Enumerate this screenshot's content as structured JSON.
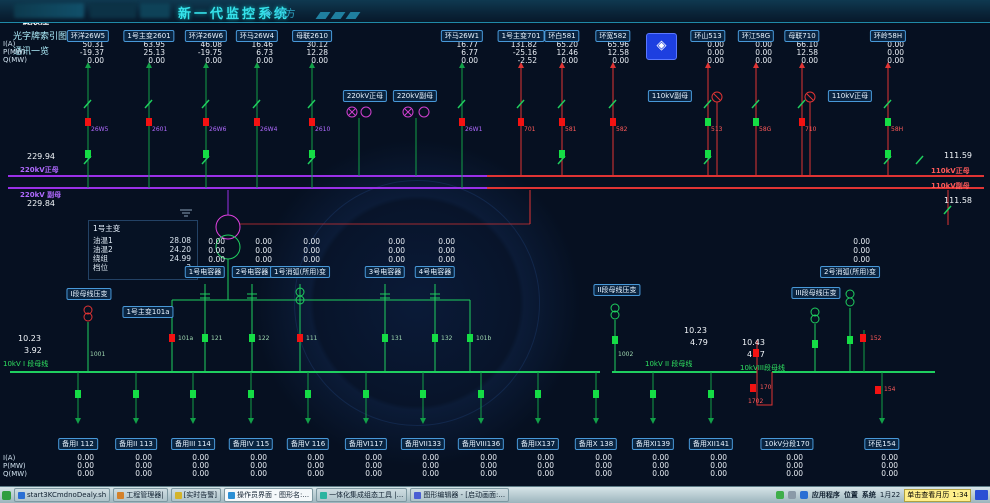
{
  "title_bar": {
    "title": "新一代监控系统",
    "vendor": "四方",
    "buttons": [
      {
        "label": "画面索引图"
      },
      {
        "label": "一键顺控",
        "state": "active"
      },
      {
        "label": "光字牌索引图"
      },
      {
        "label": "通讯一览"
      }
    ]
  },
  "icons": {
    "vendor_mark": "◈",
    "compass": "◈"
  },
  "colors": {
    "accent_cyan": "#36e2ea",
    "bus_220kv": "#9a30e8",
    "bus_110kv": "#e03434",
    "bus_10kv": "#1fcf5f",
    "breaker_closed": "#f31212",
    "breaker_open": "#15dd45",
    "background": "#061021",
    "label_border": "#4898d8",
    "tooltip_yellow": "#ffef8a"
  },
  "measure": {
    "i": "I(A)",
    "p": "P(MW)",
    "q": "Q(MW)"
  },
  "top_feeders": [
    {
      "label": "环洋26W5",
      "x": 88,
      "i": "50.31",
      "p": "-19.37",
      "q": "0.00"
    },
    {
      "label": "1号主变2601",
      "x": 149,
      "i": "63.95",
      "p": "25.13",
      "q": "0.00"
    },
    {
      "label": "环洋26W6",
      "x": 206,
      "i": "46.08",
      "p": "-19.75",
      "q": "0.00"
    },
    {
      "label": "环马26W4",
      "x": 257,
      "i": "16.46",
      "p": "6.73",
      "q": "0.00"
    },
    {
      "label": "母联2610",
      "x": 312,
      "i": "30.12",
      "p": "12.28",
      "q": "0.00"
    },
    {
      "label": "环马26W1",
      "x": 462,
      "i": "16.77",
      "p": "6.77",
      "q": "0.00"
    },
    {
      "label": "1号主变701",
      "x": 521,
      "i": "131.82",
      "p": "-25.16",
      "q": "-2.52"
    },
    {
      "label": "环白581",
      "x": 562,
      "i": "65.20",
      "p": "12.46",
      "q": "0.00"
    },
    {
      "label": "环宽582",
      "x": 613,
      "i": "65.96",
      "p": "12.58",
      "q": "0.00"
    },
    {
      "label": "环山513",
      "x": 708,
      "i": "0.00",
      "p": "0.00",
      "q": "0.00"
    },
    {
      "label": "环江58G",
      "x": 756,
      "i": "0.00",
      "p": "0.00",
      "q": "0.00"
    },
    {
      "label": "母联710",
      "x": 802,
      "i": "66.10",
      "p": "12.58",
      "q": "0.00"
    },
    {
      "label": "环岭58H",
      "x": 888,
      "i": "0.00",
      "p": "0.00",
      "q": "0.00"
    }
  ],
  "bus_boxes": [
    {
      "t": "220kV正母",
      "x": 365
    },
    {
      "t": "220kV副母",
      "x": 415
    },
    {
      "t": "110kV副母",
      "x": 670
    },
    {
      "t": "110kV正母",
      "x": 850
    }
  ],
  "bus_texts": [
    {
      "t": "220kV正母",
      "x": 20,
      "y": 165,
      "c": "vp"
    },
    {
      "t": "220kV 副母",
      "x": 20,
      "y": 190,
      "c": "vp"
    },
    {
      "t": "110kV正母",
      "x": 931,
      "y": 166,
      "c": "vr"
    },
    {
      "t": "110kV副母",
      "x": 931,
      "y": 181,
      "c": "vr"
    }
  ],
  "float_values": [
    {
      "t": "229.94",
      "x": 27,
      "y": 152
    },
    {
      "t": "229.84",
      "x": 27,
      "y": 199
    },
    {
      "t": "111.59",
      "x": 944,
      "y": 151
    },
    {
      "t": "111.58",
      "x": 944,
      "y": 196
    },
    {
      "t": "10.23",
      "x": 18,
      "y": 334
    },
    {
      "t": "3.92",
      "x": 24,
      "y": 346
    },
    {
      "t": "10.23",
      "x": 684,
      "y": 326
    },
    {
      "t": "4.79",
      "x": 690,
      "y": 338
    },
    {
      "t": "10.43",
      "x": 742,
      "y": 338
    },
    {
      "t": "4.57",
      "x": 747,
      "y": 350
    }
  ],
  "transformer": {
    "name": "1号主变",
    "rows": [
      {
        "k": "油温1",
        "v": "28.08"
      },
      {
        "k": "油温2",
        "v": "24.20"
      },
      {
        "k": "绕组",
        "v": "24.99"
      },
      {
        "k": "档位",
        "v": "3"
      }
    ]
  },
  "cap_groups": [
    {
      "label": "1号电容器",
      "x": 205,
      "v1": "0.00",
      "v2": "0.00",
      "v3": "0.00"
    },
    {
      "label": "2号电容器",
      "x": 252,
      "v1": "0.00",
      "v2": "0.00",
      "v3": "0.00"
    },
    {
      "label": "1号消弧(所用)变",
      "x": 300,
      "v1": "0.00",
      "v2": "0.00",
      "v3": "0.00"
    },
    {
      "label": "3号电容器",
      "x": 385,
      "v1": "0.00",
      "v2": "0.00",
      "v3": "0.00"
    },
    {
      "label": "4号电容器",
      "x": 435,
      "v1": "0.00",
      "v2": "0.00",
      "v3": "0.00"
    },
    {
      "label": "2号消弧(所用)变",
      "x": 850,
      "v1": "0.00",
      "v2": "0.00",
      "v3": "0.00"
    }
  ],
  "pt_boxes": [
    {
      "t": "I段母线压变",
      "x": 89,
      "y": 288
    },
    {
      "t": "1号主变101a",
      "x": 148,
      "y": 306
    },
    {
      "t": "II段母线压变",
      "x": 617,
      "y": 284
    },
    {
      "t": "III段母线压变",
      "x": 816,
      "y": 287
    }
  ],
  "bus10_labels": [
    {
      "t": "10kV I 段母线",
      "x": 3,
      "y": 359
    },
    {
      "t": "10kV II 段母线",
      "x": 645,
      "y": 359
    },
    {
      "t": "10kVIII段母线",
      "x": 740,
      "y": 363
    }
  ],
  "tags": [
    {
      "t": "26W5",
      "x": 91,
      "y": 127,
      "c": "vp"
    },
    {
      "t": "2601",
      "x": 152,
      "y": 127,
      "c": "vp"
    },
    {
      "t": "26W6",
      "x": 209,
      "y": 127,
      "c": "vp"
    },
    {
      "t": "26W4",
      "x": 260,
      "y": 127,
      "c": "vp"
    },
    {
      "t": "2610",
      "x": 315,
      "y": 127,
      "c": "vp"
    },
    {
      "t": "26W1",
      "x": 465,
      "y": 127,
      "c": "vp"
    },
    {
      "t": "701",
      "x": 524,
      "y": 127,
      "c": "vr"
    },
    {
      "t": "581",
      "x": 565,
      "y": 127,
      "c": "vr"
    },
    {
      "t": "582",
      "x": 616,
      "y": 127,
      "c": "vr"
    },
    {
      "t": "513",
      "x": 711,
      "y": 127,
      "c": "vr"
    },
    {
      "t": "58G",
      "x": 759,
      "y": 127,
      "c": "vr"
    },
    {
      "t": "710",
      "x": 805,
      "y": 127,
      "c": "vr"
    },
    {
      "t": "58H",
      "x": 891,
      "y": 127,
      "c": "vr"
    },
    {
      "t": "101a",
      "x": 178,
      "y": 336,
      "c": "vg"
    },
    {
      "t": "121",
      "x": 211,
      "y": 336,
      "c": "vg"
    },
    {
      "t": "122",
      "x": 258,
      "y": 336,
      "c": "vg"
    },
    {
      "t": "111",
      "x": 306,
      "y": 336,
      "c": "vg"
    },
    {
      "t": "131",
      "x": 391,
      "y": 336,
      "c": "vg"
    },
    {
      "t": "132",
      "x": 441,
      "y": 336,
      "c": "vg"
    },
    {
      "t": "101b",
      "x": 476,
      "y": 336,
      "c": "vg"
    },
    {
      "t": "152",
      "x": 870,
      "y": 336,
      "c": "vr"
    },
    {
      "t": "170",
      "x": 760,
      "y": 385,
      "c": "vr"
    },
    {
      "t": "1702",
      "x": 748,
      "y": 399,
      "c": "vr"
    },
    {
      "t": "154",
      "x": 884,
      "y": 387,
      "c": "vr"
    },
    {
      "t": "1001",
      "x": 90,
      "y": 352,
      "c": "vg"
    },
    {
      "t": "1002",
      "x": 618,
      "y": 352,
      "c": "vg"
    }
  ],
  "breakers": [
    {
      "x": 85,
      "y": 118,
      "state": "closed"
    },
    {
      "x": 146,
      "y": 118,
      "state": "closed"
    },
    {
      "x": 203,
      "y": 118,
      "state": "closed"
    },
    {
      "x": 254,
      "y": 118,
      "state": "closed"
    },
    {
      "x": 309,
      "y": 118,
      "state": "closed"
    },
    {
      "x": 459,
      "y": 118,
      "state": "closed"
    },
    {
      "x": 518,
      "y": 118,
      "state": "closed"
    },
    {
      "x": 559,
      "y": 118,
      "state": "closed"
    },
    {
      "x": 610,
      "y": 118,
      "state": "closed"
    },
    {
      "x": 799,
      "y": 118,
      "state": "closed"
    },
    {
      "x": 705,
      "y": 118,
      "state": "open"
    },
    {
      "x": 753,
      "y": 118,
      "state": "open"
    },
    {
      "x": 885,
      "y": 118,
      "state": "open"
    },
    {
      "x": 85,
      "y": 150,
      "state": "open"
    },
    {
      "x": 203,
      "y": 150,
      "state": "open"
    },
    {
      "x": 309,
      "y": 150,
      "state": "open"
    },
    {
      "x": 559,
      "y": 150,
      "state": "open"
    },
    {
      "x": 705,
      "y": 150,
      "state": "open"
    },
    {
      "x": 885,
      "y": 150,
      "state": "open"
    },
    {
      "x": 169,
      "y": 334,
      "state": "closed"
    },
    {
      "x": 202,
      "y": 334,
      "state": "open"
    },
    {
      "x": 249,
      "y": 334,
      "state": "open"
    },
    {
      "x": 297,
      "y": 334,
      "state": "closed"
    },
    {
      "x": 382,
      "y": 334,
      "state": "open"
    },
    {
      "x": 432,
      "y": 334,
      "state": "open"
    },
    {
      "x": 467,
      "y": 334,
      "state": "open"
    },
    {
      "x": 612,
      "y": 336,
      "state": "open"
    },
    {
      "x": 812,
      "y": 340,
      "state": "open"
    },
    {
      "x": 847,
      "y": 336,
      "state": "open"
    },
    {
      "x": 860,
      "y": 334,
      "state": "closed"
    },
    {
      "x": 750,
      "y": 384,
      "state": "closed"
    },
    {
      "x": 753,
      "y": 349,
      "state": "closed"
    },
    {
      "x": 875,
      "y": 386,
      "state": "closed"
    },
    {
      "x": 75,
      "y": 390,
      "state": "open"
    },
    {
      "x": 133,
      "y": 390,
      "state": "open"
    },
    {
      "x": 190,
      "y": 390,
      "state": "open"
    },
    {
      "x": 248,
      "y": 390,
      "state": "open"
    },
    {
      "x": 305,
      "y": 390,
      "state": "open"
    },
    {
      "x": 363,
      "y": 390,
      "state": "open"
    },
    {
      "x": 420,
      "y": 390,
      "state": "open"
    },
    {
      "x": 478,
      "y": 390,
      "state": "open"
    },
    {
      "x": 535,
      "y": 390,
      "state": "open"
    },
    {
      "x": 593,
      "y": 390,
      "state": "open"
    },
    {
      "x": 650,
      "y": 390,
      "state": "open"
    },
    {
      "x": 708,
      "y": 390,
      "state": "open"
    }
  ],
  "bottom_feeders": [
    {
      "label": "备用I 112",
      "x": 78,
      "i": "0.00",
      "p": "0.00",
      "q": "0.00"
    },
    {
      "label": "备用II 113",
      "x": 136,
      "i": "0.00",
      "p": "0.00",
      "q": "0.00"
    },
    {
      "label": "备用III 114",
      "x": 193,
      "i": "0.00",
      "p": "0.00",
      "q": "0.00"
    },
    {
      "label": "备用IV 115",
      "x": 251,
      "i": "0.00",
      "p": "0.00",
      "q": "0.00"
    },
    {
      "label": "备用V 116",
      "x": 308,
      "i": "0.00",
      "p": "0.00",
      "q": "0.00"
    },
    {
      "label": "备用VI117",
      "x": 366,
      "i": "0.00",
      "p": "0.00",
      "q": "0.00"
    },
    {
      "label": "备用VII133",
      "x": 423,
      "i": "0.00",
      "p": "0.00",
      "q": "0.00"
    },
    {
      "label": "备用VIII136",
      "x": 481,
      "i": "0.00",
      "p": "0.00",
      "q": "0.00"
    },
    {
      "label": "备用IX137",
      "x": 538,
      "i": "0.00",
      "p": "0.00",
      "q": "0.00"
    },
    {
      "label": "备用X 138",
      "x": 596,
      "i": "0.00",
      "p": "0.00",
      "q": "0.00"
    },
    {
      "label": "备用XI139",
      "x": 653,
      "i": "0.00",
      "p": "0.00",
      "q": "0.00"
    },
    {
      "label": "备用XII141",
      "x": 711,
      "i": "0.00",
      "p": "0.00",
      "q": "0.00"
    },
    {
      "label": "10kV分段170",
      "x": 787,
      "i": "0.00",
      "p": "0.00",
      "q": "0.00"
    },
    {
      "label": "环民154",
      "x": 882,
      "i": "0.00",
      "p": "0.00",
      "q": "0.00"
    }
  ],
  "taskbar": {
    "items": [
      {
        "label": "start3KCmdnoDealy.sh",
        "icon": "#2a6fd4"
      },
      {
        "label": "工程管理器|",
        "icon": "#d4812a"
      },
      {
        "label": "[实时告警]",
        "icon": "#d4b42a"
      },
      {
        "label": "操作员界面 - 图形名:...",
        "icon": "#2a8fd4",
        "state": "active"
      },
      {
        "label": "一体化集成组态工具 |...",
        "icon": "#2ab4a0"
      },
      {
        "label": "图形编辑器 - [启动画面:...",
        "icon": "#4a5fd4"
      }
    ],
    "tray_icons": [
      "#3fae4a",
      "#8a9aa8",
      "#2a6fd4"
    ],
    "menus": [
      "应用程序",
      "位置",
      "系统"
    ],
    "date": "1月22",
    "tooltip": "单击查看月历",
    "time": "1:34"
  }
}
